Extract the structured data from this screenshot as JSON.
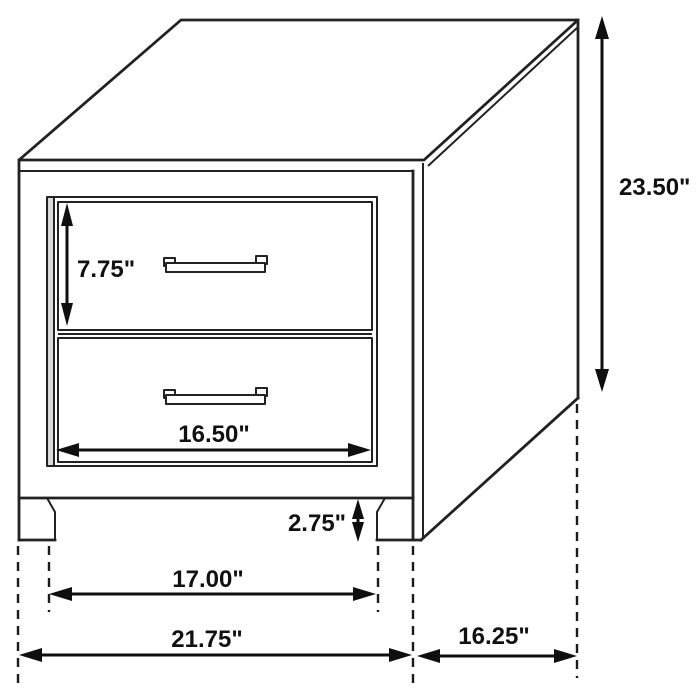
{
  "dims": {
    "height": "23.50\"",
    "drawer_height": "7.75\"",
    "drawer_opening_width": "16.50\"",
    "base_height": "2.75\"",
    "leg_span": "17.00\"",
    "overall_width": "21.75\"",
    "depth": "16.25\""
  },
  "colors": {
    "line": "#222222",
    "dimension": "#0f0f0f",
    "background": "#ffffff"
  }
}
